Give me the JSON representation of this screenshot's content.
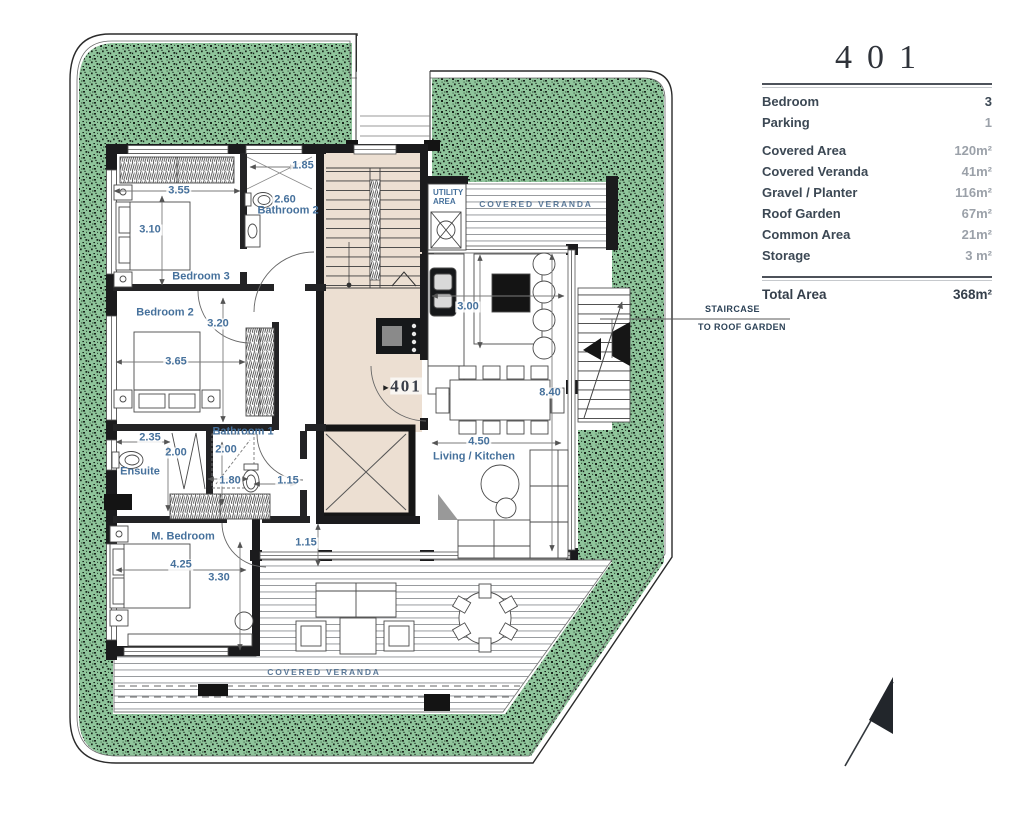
{
  "colors": {
    "planter_green": "#8fc59b",
    "stair_beige": "#ecdfd2",
    "dim_blue": "#46719c",
    "navy": "#2c4257",
    "wall_black": "#1b1b1d"
  },
  "legend": {
    "unit_number": "401",
    "rows": [
      {
        "label": "Bedroom",
        "value": "3"
      },
      {
        "label": "Parking",
        "value": "1"
      },
      {
        "label": "Covered Area",
        "value": "120m²"
      },
      {
        "label": "Covered Veranda",
        "value": "41m²"
      },
      {
        "label": "Gravel / Planter",
        "value": "116m²"
      },
      {
        "label": "Roof Garden",
        "value": "67m²"
      },
      {
        "label": "Common Area",
        "value": "21m²"
      },
      {
        "label": "Storage",
        "value": "3 m²"
      }
    ],
    "total": {
      "label": "Total Area",
      "value": "368m²"
    }
  },
  "plan": {
    "unit_label": "401",
    "entry_marker": "►",
    "rooms": {
      "bedroom3": "Bedroom 3",
      "bedroom2": "Bedroom 2",
      "bathroom2": "Bathroom 2",
      "bathroom1": "Bathroom 1",
      "ensuite": "Ensuite",
      "master_bedroom": "M. Bedroom",
      "living_kitchen": "Living / Kitchen",
      "utility_line1": "UTILITY",
      "utility_line2": "AREA",
      "covered_veranda_top": "COVERED VERANDA",
      "covered_veranda_bottom": "COVERED VERANDA"
    },
    "dimensions": {
      "bath2_width": "1.85",
      "bed3_width": "3.55",
      "bath2_depth": "2.60",
      "bed3_depth": "3.10",
      "bed2_depth": "3.20",
      "bed2_width": "3.65",
      "ensuite_width": "2.35",
      "ensuite_depth": "2.00",
      "bath1_depth": "2.00",
      "bath1_width": "1.80",
      "hall_width": "1.15",
      "lobby_width": "1.15",
      "master_width": "4.25",
      "master_depth": "3.30",
      "kitchen_depth": "3.00",
      "living_width": "4.50",
      "living_depth": "8.40"
    },
    "annotation": {
      "line1": "STAIRCASE",
      "line2": "TO ROOF GARDEN"
    }
  }
}
